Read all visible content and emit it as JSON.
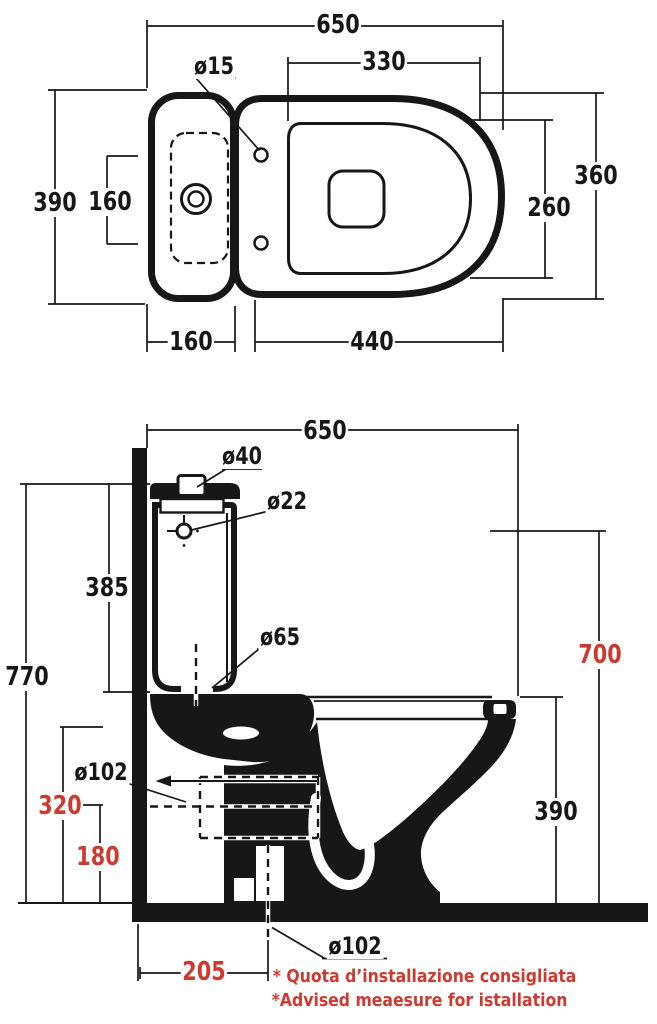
{
  "drawing_title": "WC close-coupled installation drawing",
  "colors": {
    "ink": "#171717",
    "red": "#cc3a31",
    "paper": "#ffffff"
  },
  "top_view": {
    "dims": {
      "overall_width": "650",
      "seat_inner_length": "330",
      "hinge_hole_diameter": "ø15",
      "tank_width": "390",
      "hinge_spacing": "160",
      "bowl_width": "360",
      "bowl_inner_width": "260",
      "tank_depth": "160",
      "bowl_length": "440"
    }
  },
  "side_view": {
    "dims": {
      "overall_depth": "650",
      "lid_button_diameter": "ø40",
      "water_inlet_diameter": "ø22",
      "tank_height": "385",
      "overall_height": "770",
      "inlet_height": "700",
      "flush_valve_diameter": "ø65",
      "rear_outlet_diameter": "ø102",
      "rear_outlet_height": "320",
      "outlet_axis_height": "180",
      "bowl_height": "390",
      "floor_outlet_diameter": "ø102",
      "floor_outlet_distance": "205"
    }
  },
  "footnotes": {
    "line1": "* Quota d’installazione consigliata",
    "line2": "*Advised meaesure for istallation"
  }
}
